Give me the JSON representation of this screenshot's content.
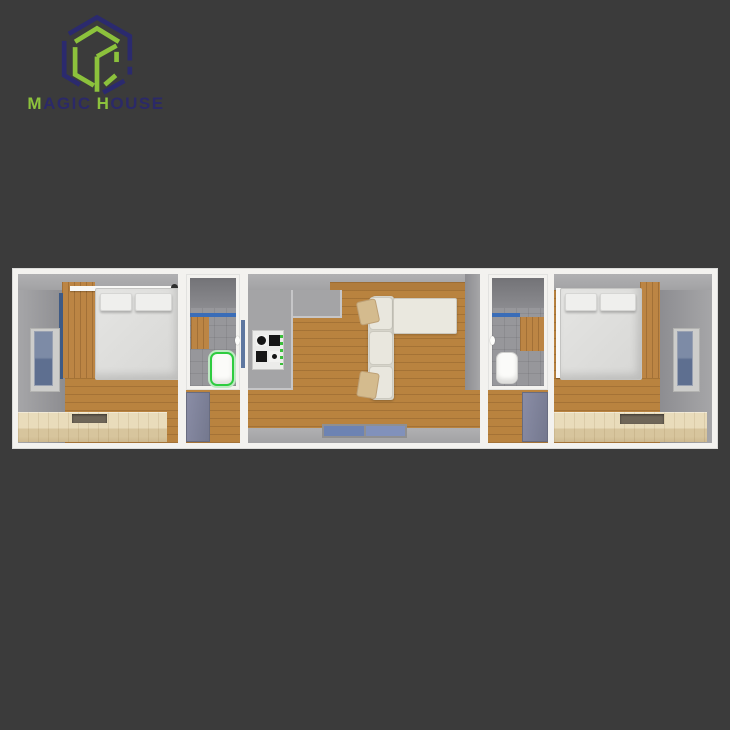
{
  "page": {
    "background": "#3b3b3b"
  },
  "logo": {
    "word1_initial": "M",
    "word1_rest": "AGIC",
    "word2_initial": "H",
    "word2_rest": "OUSE",
    "brand_navy": "#2b2968",
    "brand_green": "#8cc23c"
  },
  "floorplan": {
    "type": "container-house-top-down-3d-render",
    "rooms": [
      {
        "name": "bedroom-left",
        "features": [
          "double-bed",
          "two-pillows",
          "wall-window",
          "wood-accent-wall",
          "storage-platform"
        ]
      },
      {
        "name": "bathroom-left",
        "features": [
          "toilet-highlighted-green",
          "blue-shower-strip",
          "wood-vanity",
          "corridor-below"
        ]
      },
      {
        "name": "living-kitchen",
        "features": [
          "cooktop-4-burners",
          "l-shaped-sofa",
          "two-sofa-pillows",
          "blue-entry-mats",
          "kitchen-gray-floor"
        ]
      },
      {
        "name": "bathroom-right",
        "features": [
          "toilet",
          "blue-shower-strip",
          "wood-vanity",
          "corridor-below"
        ]
      },
      {
        "name": "bedroom-right",
        "features": [
          "double-bed",
          "two-pillows",
          "wall-window",
          "wood-accent-wall",
          "storage-platform"
        ]
      }
    ],
    "colors": {
      "frame_white": "#f3f2ef",
      "wall_gray": "#9b9b9d",
      "wood_floor": "#b9833f",
      "accent_wood": "#bc8544",
      "platform_wood": "#e3d5b3",
      "bed_white": "#dcdcda",
      "sofa_cream": "#e9e7de",
      "window_blue": "#6e82a4",
      "shower_strip_blue": "#3a6db8",
      "mat_blue": "#6d83b3",
      "toilet_highlight_green": "#2ecc40",
      "kitchen_floor_gray": "#a4a4a6"
    }
  }
}
